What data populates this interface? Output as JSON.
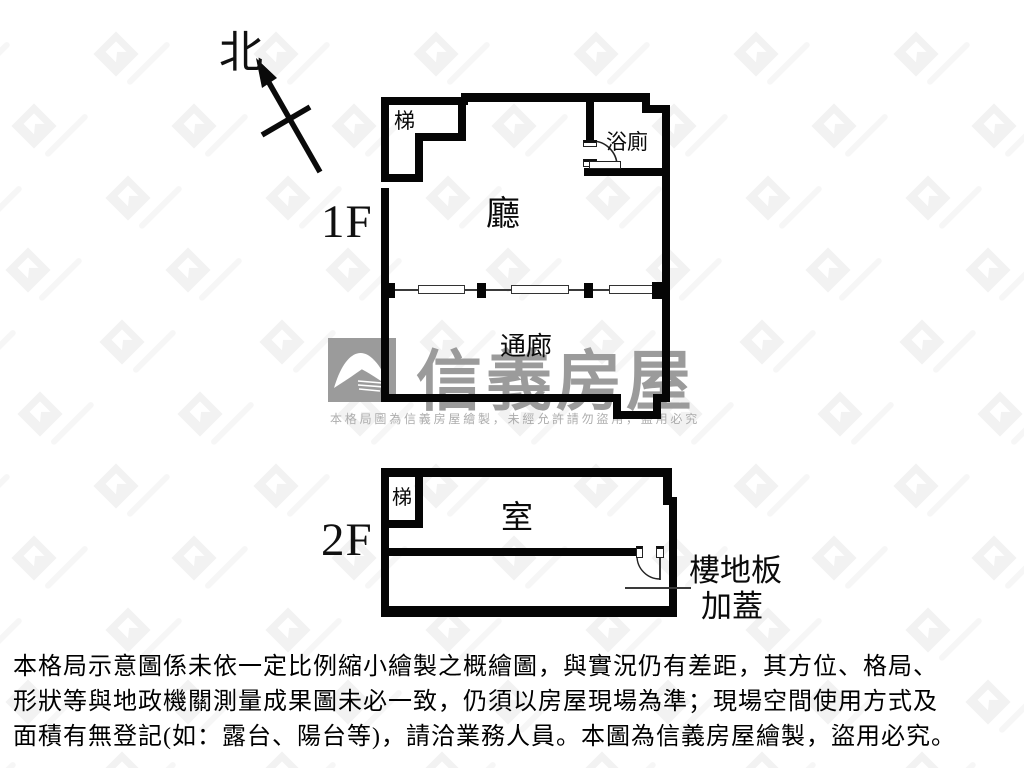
{
  "compass": {
    "label": "北"
  },
  "floor1": {
    "label": "1F",
    "rooms": {
      "stairs": "梯",
      "bathroom": "浴廁",
      "living_room": "廳",
      "corridor": "通廊"
    }
  },
  "floor2": {
    "label": "2F",
    "rooms": {
      "stairs": "梯",
      "room": "室"
    },
    "annotation": {
      "line1": "樓地板",
      "line2": "加蓋"
    }
  },
  "watermark": {
    "brand": "信義房屋",
    "notice": "本格局圖為信義房屋繪製，未經允許請勿盜用，盜用必究",
    "colors": {
      "logo": "#9b9b9b",
      "brand_text": "#9b9b9b",
      "notice_text": "#adadad"
    }
  },
  "disclaimer": {
    "line1": "本格局示意圖係未依一定比例縮小繪製之概繪圖，與實況仍有差距，其方位、格局、",
    "line2": "形狀等與地政機關測量成果圖未必一致，仍須以房屋現場為準；現場空間使用方式及",
    "line3": "面積有無登記(如：露台、陽台等)，請洽業務人員。本圖為信義房屋繪製，盜用必究。"
  },
  "colors": {
    "wall": "#050505",
    "background": "#ffffff"
  }
}
